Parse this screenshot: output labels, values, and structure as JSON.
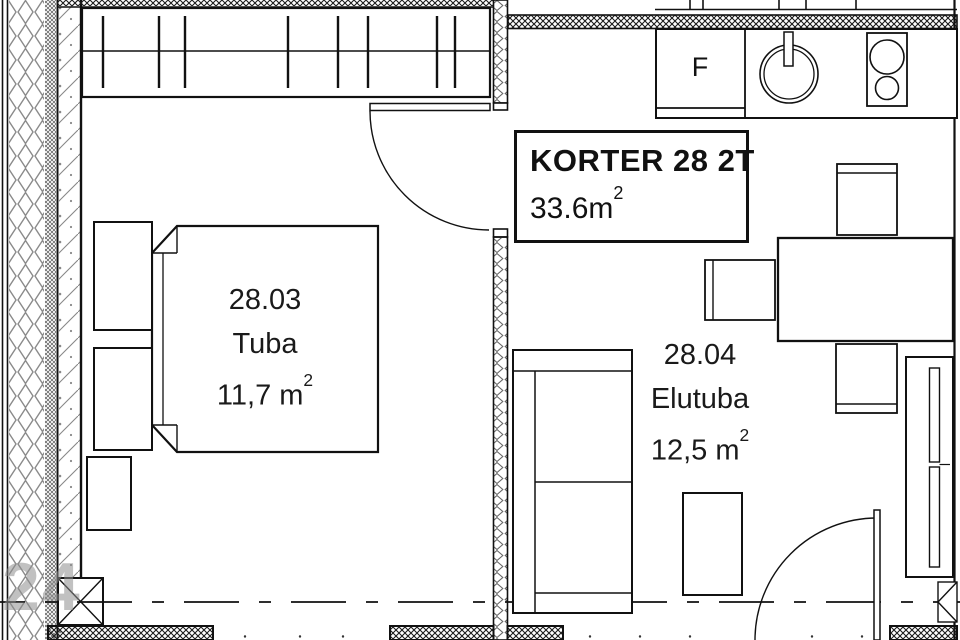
{
  "title_block": {
    "title": "KORTER 28 2T",
    "area_value": "33.6m",
    "area_sup": "2"
  },
  "rooms": {
    "bedroom": {
      "number": "28.03",
      "name": "Tuba",
      "area": "11,7 m",
      "area_sup": "2"
    },
    "living": {
      "number": "28.04",
      "name": "Elutuba",
      "area": "12,5 m",
      "area_sup": "2"
    }
  },
  "kitchen": {
    "fridge_label": "F"
  },
  "watermark": "24",
  "furniture_icons": [
    "wardrobe-icon",
    "bed-icon",
    "nightstand-icon",
    "dresser-icon",
    "sofa-icon",
    "coffee-table-icon",
    "dining-table-icon",
    "chair-icon",
    "tv-bench-icon",
    "fridge-icon",
    "sink-icon",
    "stove-icon",
    "door-swing-icon",
    "column-icon"
  ],
  "colors": {
    "line": "#111111",
    "hatch_dark": "#1a1a1a",
    "insulation_gray": "#888888",
    "concrete_gray": "#777777",
    "watermark_gray": "#8f8f8f",
    "background": "#ffffff"
  }
}
